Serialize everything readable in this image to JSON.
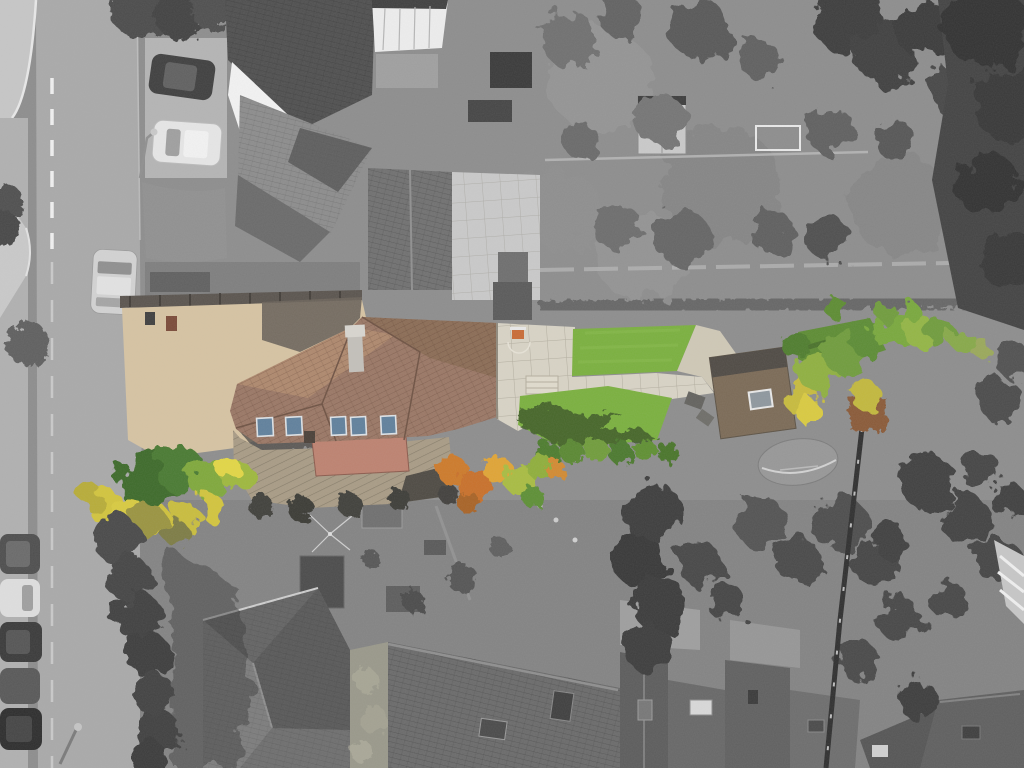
{
  "meta": {
    "type": "aerial-drone-photograph",
    "technique": "selective-colour: subject property shown in colour, all surroundings desaturated to grayscale",
    "subject": "detached house with terracotta tiled roof, gravel driveway, paved patio, two bright artificial lawns, timber outbuilding and a long autumn-coloured garden strip",
    "setting": "suburban street top-left with dashed centre line and parked cars; neighbouring grayscale houses, long rear gardens and terraced roofs below"
  },
  "counts": {
    "skylights_on_main_roof": 5,
    "lawns_in_colour": 3,
    "outbuilding_skylights": 1,
    "parked_cars_left_column": 5,
    "cars_near_top_parking": 2,
    "cars_on_road": 2,
    "street_lamps": 2,
    "football_goals": 1
  },
  "road_marking": "dashed white centre line",
  "palette": {
    "grayGround": "#8d8d8d",
    "road": "#a9a9a9",
    "roadLine": "#f0f0f0",
    "pavement": "#c6c6c6",
    "kerb": "#e8e8e8",
    "driveGravel": "#d6c3a2",
    "driveShadow": "#514e49",
    "boundaryWall": "#5a544e",
    "roofBase": "#9a7765",
    "roofLight": "#b18b6f",
    "roofDark": "#8a6a53",
    "roofEdge": "#6e5243",
    "skylightGlass": "#60809c",
    "skylightFrame": "#dde2e6",
    "chimney": "#c3c0ba",
    "flatRoof": "#bd8270",
    "extensionRoof": "#a89b85",
    "extensionEdge": "#4e4a43",
    "patio": "#d8d3c5",
    "patioJoint": "#a9a494",
    "lawnBright": "#7ab03e",
    "lawnFar": "#5d8c33",
    "lawnShadow": "#3c5a28",
    "outbuildingRoof": "#7b6a56",
    "outbuildingGable": "#4f4a44",
    "hedgeDarkGreen": "#3e6b2a",
    "hedgeYellow": "#d2c43c",
    "autumnOrange": "#cd7a2c",
    "autumnYellowGreen": "#a8bc42",
    "treeGreen": "#6f9c3c",
    "grayTree": "#565656",
    "grayTreeDark": "#3c3c3c",
    "forest": "#434343",
    "roofGrayDark": "#4f4f4f",
    "roofGray": "#8c8c8c",
    "roofGrayMid": "#707070",
    "roofWhite": "#f2f2f2",
    "mossRoof": "#99988a",
    "carDark": "#474747",
    "carWhite": "#e6e6e6",
    "carSilver": "#d2d2d2",
    "fence": "#2f2f2f",
    "shedRust": "#8a5a38",
    "hoopOrange": "#c96b35"
  }
}
